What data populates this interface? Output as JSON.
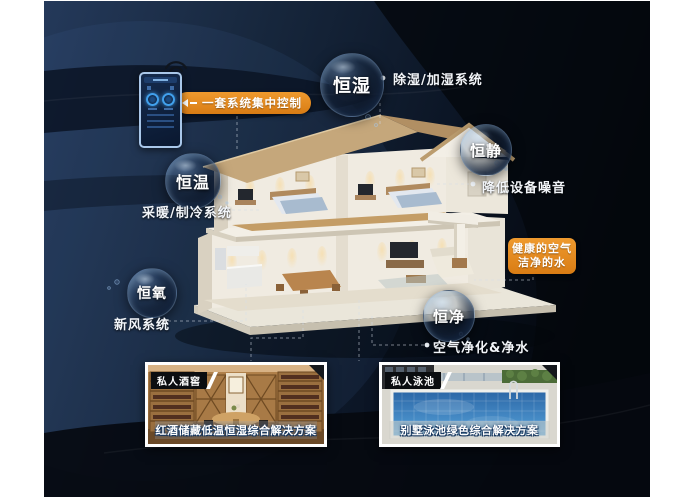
{
  "colors": {
    "accent_orange": "#E08620",
    "canvas_navy": "#18263C",
    "wave_black": "#05080F"
  },
  "callouts": {
    "control": "一套系统集中控制",
    "healthy_line1": "健康的空气",
    "healthy_line2": "洁净的水"
  },
  "bubbles": [
    {
      "label": "恒湿",
      "sub": "除湿/加湿系统"
    },
    {
      "label": "恒静",
      "sub": "降低设备噪音"
    },
    {
      "label": "恒温",
      "sub": "采暖/制冷系统"
    },
    {
      "label": "恒氧",
      "sub": "新风系统"
    },
    {
      "label": "恒净",
      "sub": "空气净化&净水"
    }
  ],
  "photos": [
    {
      "tag": "私人酒窖",
      "caption": "红酒储藏低温恒湿综合解决方案"
    },
    {
      "tag": "私人泳池",
      "caption": "别墅泳池绿色综合解决方案"
    }
  ]
}
